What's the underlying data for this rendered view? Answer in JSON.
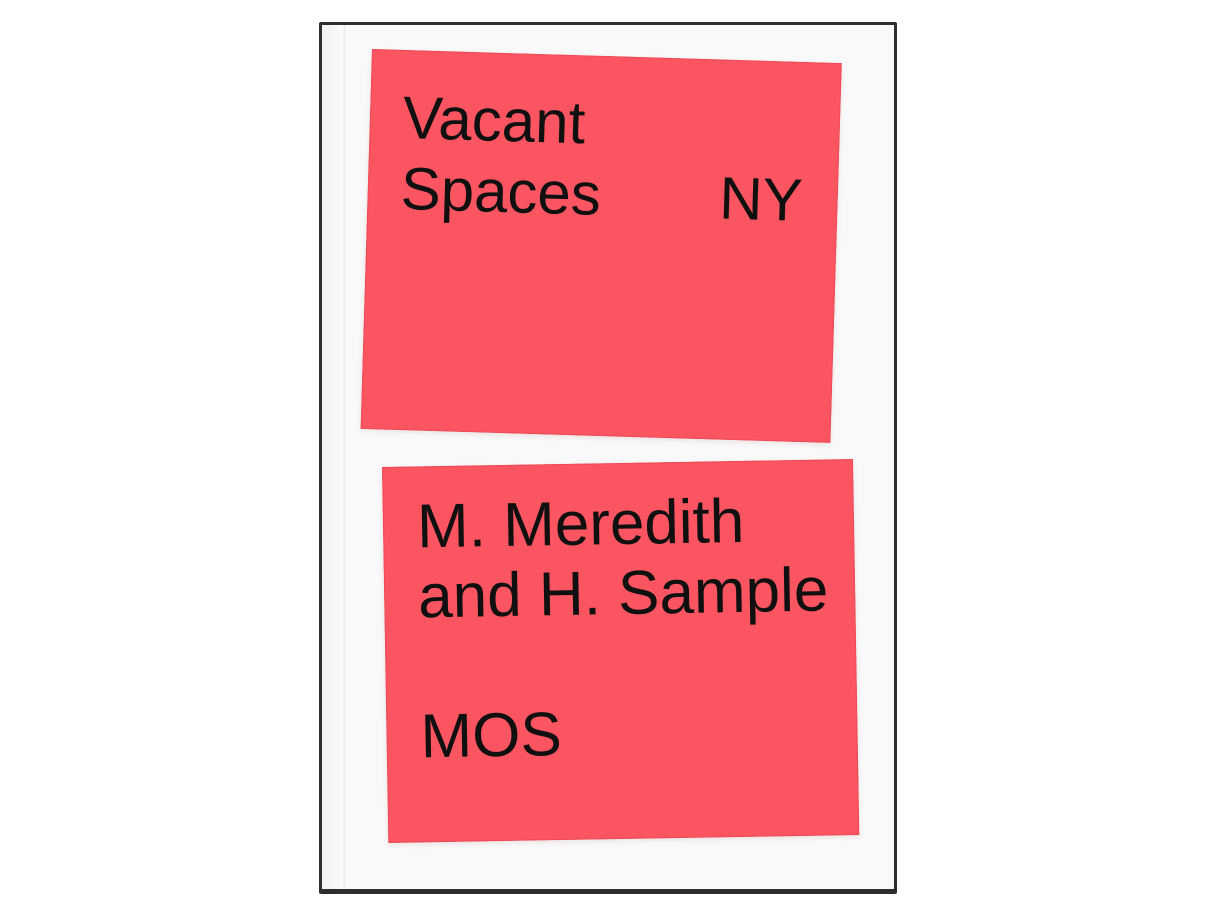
{
  "cover": {
    "title": {
      "line1": "Vacant",
      "line2": "Spaces",
      "region": "NY"
    },
    "authors": {
      "line1": "M. Meredith",
      "line2": "and H. Sample"
    },
    "studio": "MOS",
    "colors": {
      "page-bg": "#ffffff",
      "panel-red": "#fa5560",
      "panel-edge": "#d83040",
      "ink": "#101010",
      "cover-paper": "#f9f9f9",
      "book-edge": "#2e2e2e",
      "crease": "#ececec"
    }
  }
}
